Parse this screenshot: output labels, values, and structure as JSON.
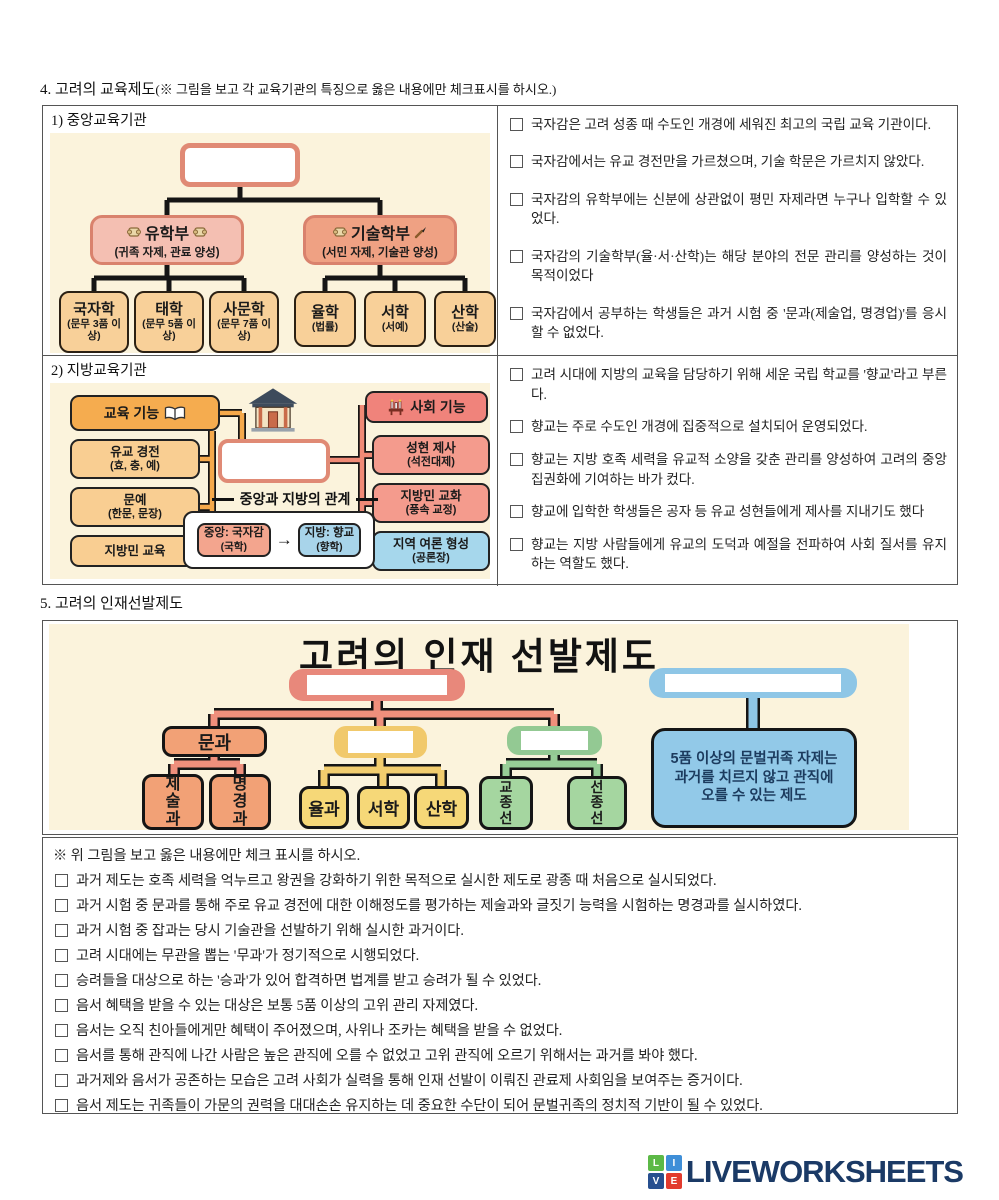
{
  "sections": {
    "edu_title_num": "4. 고려의 교육제도",
    "edu_title_paren": "(※ 그림을 보고 각 교육기관의 특징으로 옳은 내용에만 체크표시를 하시오.)",
    "select_title": "5. 고려의 인재선발제도"
  },
  "central": {
    "label": "1) 중앙교육기관",
    "diagram": {
      "confucian": {
        "title": "유학부",
        "subtitle": "(귀족 자제, 관료 양성)"
      },
      "technical": {
        "title": "기술학부",
        "subtitle": "(서민 자제, 기술관 양성)"
      },
      "confucian_children": [
        {
          "name": "국자학",
          "desc": "(문무 3품 이상)"
        },
        {
          "name": "태학",
          "desc": "(문무 5품 이상)"
        },
        {
          "name": "사문학",
          "desc": "(문무 7품 이상)"
        }
      ],
      "technical_children": [
        {
          "name": "율학",
          "desc": "(법률)"
        },
        {
          "name": "서학",
          "desc": "(서예)"
        },
        {
          "name": "산학",
          "desc": "(산술)"
        }
      ]
    },
    "statements": [
      "국자감은 고려 성종 때 수도인 개경에 세워진 최고의 국립 교육 기관이다.",
      "국자감에서는 유교 경전만을 가르쳤으며, 기술 학문은 가르치지 않았다.",
      "국자감의 유학부에는 신분에 상관없이 평민 자제라면 누구나 입학할 수 있었다.",
      "국자감의 기술학부(율·서·산학)는 해당 분야의 전문 관리를 양성하는 것이 목적이었다",
      "국자감에서 공부하는 학생들은 과거 시험 중 '문과(제술업, 명경업)'를 응시할 수 없었다."
    ]
  },
  "local": {
    "label": "2) 지방교육기관",
    "diagram": {
      "edu_header": "교육 기능",
      "edu_items": [
        {
          "line1": "유교 경전",
          "line2": "(효, 충, 예)"
        },
        {
          "line1": "문예",
          "line2": "(한문, 문장)"
        },
        {
          "line1": "지방민 교육",
          "line2": ""
        }
      ],
      "social_header": "사회 기능",
      "social_items": [
        {
          "line1": "성현 제사",
          "line2": "(석전대제)"
        },
        {
          "line1": "지방민 교화",
          "line2": "(풍속 교정)"
        },
        {
          "line1": "지역 여론 형성",
          "line2": "(공론장)"
        }
      ],
      "relation_title": "중앙과 지방의 관계",
      "relation_center": {
        "line1": "중앙: 국자감",
        "line2": "(국학)"
      },
      "relation_arrow": "→",
      "relation_local": {
        "line1": "지방: 향교",
        "line2": "(향학)"
      }
    },
    "statements": [
      "고려 시대에 지방의 교육을 담당하기 위해 세운 국립 학교를 '향교'라고 부른다.",
      "향교는 주로 수도인 개경에 집중적으로 설치되어 운영되었다.",
      "향교는 지방 호족 세력을 유교적 소양을 갖춘 관리를 양성하여 고려의 중앙 집권화에 기여하는 바가 컸다.",
      "향교에 입학한 학생들은 공자 등 유교 성현들에게 제사를 지내기도 했다",
      "향교는 지방 사람들에게 유교의 도덕과 예절을 전파하여 사회 질서를 유지하는 역할도 했다."
    ]
  },
  "selection": {
    "diagram_title": "고려의 인재 선발제도",
    "munkwa": "문과",
    "munkwa_children": [
      "제술과",
      "명경과"
    ],
    "japkwa_children": [
      "율과",
      "서학",
      "산학"
    ],
    "seunggwa_children": [
      "교종선",
      "선종선"
    ],
    "eumseo_text": "5품 이상의 문벌귀족 자제는 과거를 치르지 않고 관직에 오를 수 있는 제도"
  },
  "quiz": {
    "header": "※ 위 그림을 보고 옳은 내용에만 체크 표시를 하시오.",
    "items": [
      "과거 제도는 호족 세력을 억누르고 왕권을 강화하기 위한 목적으로 실시한 제도로 광종 때 처음으로 실시되었다.",
      "과거 시험 중 문과를 통해 주로 유교 경전에 대한 이해정도를 평가하는 제술과와 글짓기 능력을 시험하는 명경과를 실시하였다.",
      "과거 시험 중 잡과는 당시 기술관을 선발하기 위해 실시한 과거이다.",
      "고려 시대에는 무관을 뽑는 '무과'가 정기적으로 시행되었다.",
      "승려들을 대상으로 하는 '승과'가 있어 합격하면 법계를 받고 승려가 될 수 있었다.",
      "음서 혜택을 받을 수 있는 대상은 보통 5품 이상의 고위 관리 자제였다.",
      "음서는 오직 친아들에게만 혜택이 주어졌으며, 사위나 조카는 혜택을 받을 수 없었다.",
      "음서를 통해 관직에 나간 사람은 높은 관직에 오를 수 없었고 고위 관직에 오르기 위해서는 과거를 봐야 했다.",
      "과거제와 음서가 공존하는 모습은 고려 사회가 실력을 통해 인재 선발이 이뤄진 관료제 사회임을 보여주는 증거이다.",
      "음서 제도는 귀족들이 가문의 권력을 대대손손 유지하는 데 중요한 수단이 되어 문벌귀족의 정치적 기반이 될 수 있었다."
    ]
  },
  "footer": {
    "brand": "LIVEWORKSHEETS",
    "logo_letters": [
      "L",
      "I",
      "V",
      "E"
    ]
  }
}
